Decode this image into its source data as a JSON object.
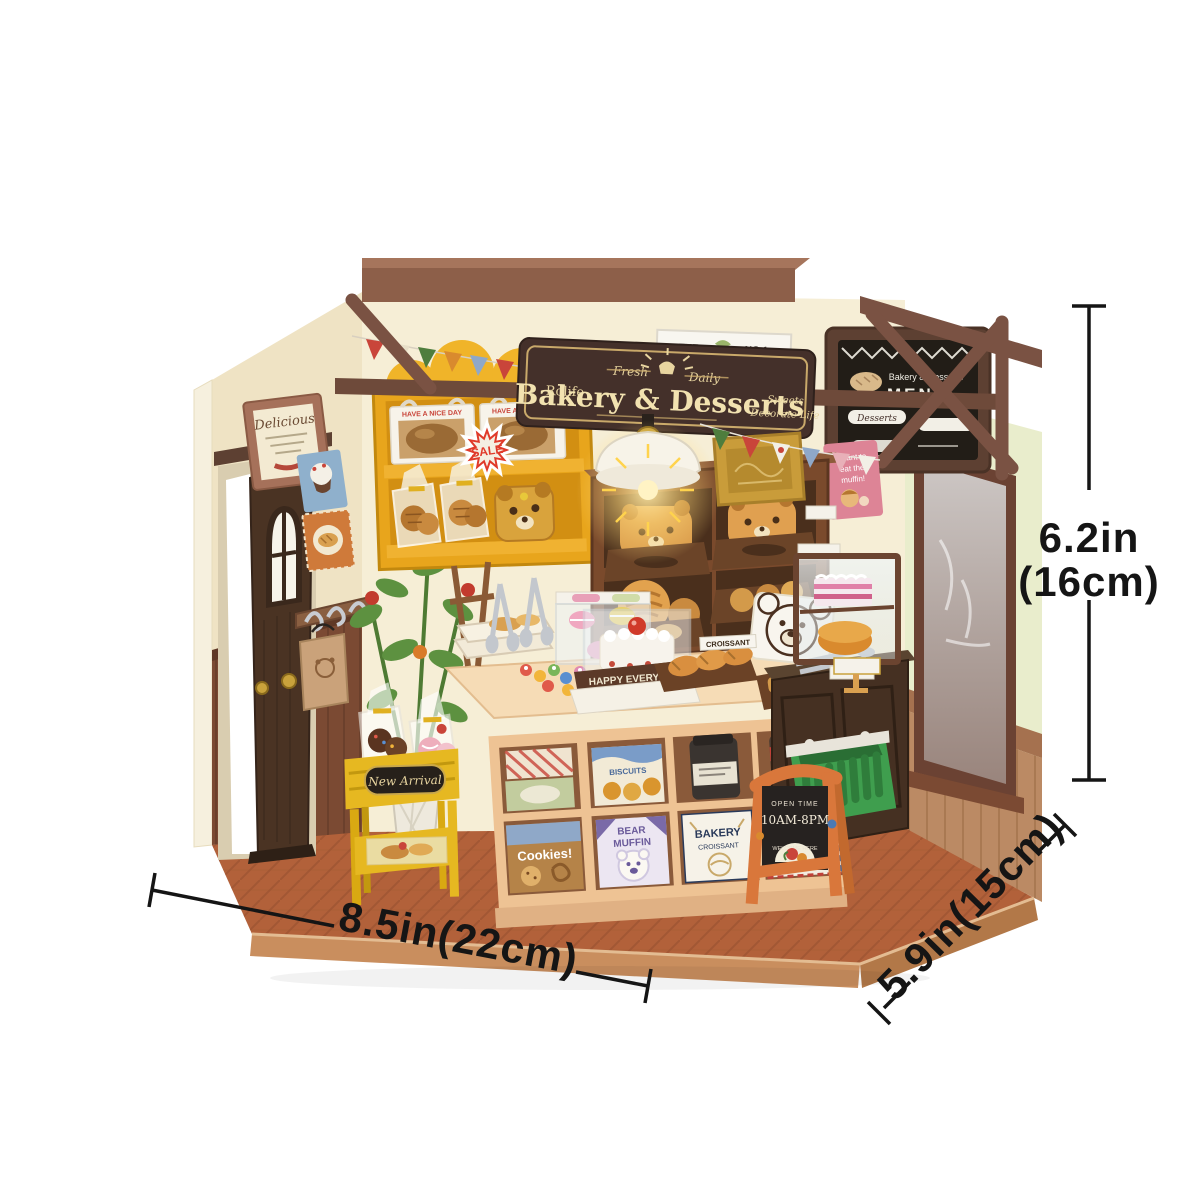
{
  "annotations": {
    "height_in": "6.2in",
    "height_cm": "(16cm)",
    "width_label": "8.5in(22cm)",
    "depth_label": "5.9in(15cm)"
  },
  "storefront": {
    "hanging_sign": {
      "brand": "Rolife",
      "title": "Bakery & Desserts",
      "banner_left": "Fresh",
      "banner_right": "Daily",
      "tagline_line1": "Sweets",
      "tagline_line2": "Decorate Life"
    },
    "wall_poster": {
      "line1": "THE",
      "line2": "NO.1",
      "line3": "YUM BAKERY"
    },
    "menu_board": {
      "header": "Bakery & Desserts",
      "title": "MENU",
      "item1": "Desserts"
    },
    "framed_print": "Delicious",
    "sale_badge": "SALE",
    "bread_box_text": "HAVE A NICE DAY",
    "sticky_note": {
      "line1": "I want to",
      "line2": "eat the",
      "line3": "muffin!"
    },
    "happy_sign": "HAPPY EVERYDAY",
    "croissant_tag": "CROISSANT",
    "new_arrival_plaque": "New Arrival",
    "open_sign": {
      "line1": "OPEN TIME",
      "line2": "10AM-8PM",
      "line3": "WELCOME HERE"
    },
    "counter_boxes": {
      "biscuits": "BISCUITS",
      "cookies": "Cookies!",
      "muffin_line1": "BEAR",
      "muffin_line2": "MUFFIN",
      "bakery_line1": "BAKERY",
      "bakery_line2": "CROISSANT",
      "croissant": "CROISSANT"
    }
  },
  "colors": {
    "wall_cream": "#f6eed6",
    "wall_mint": "#e9edcc",
    "wood_dark": "#6e4a3a",
    "wainscot": "#7b4a33",
    "floor_terracotta": "#b2613a",
    "shelf_yellow": "#e8a51c",
    "sign_brown": "#44302a",
    "sign_gold": "#d8b56a",
    "sale_red": "#e03a2a",
    "basket_green": "#3f9e4e",
    "aframe_orange": "#d9773b",
    "counter_peach": "#eec394",
    "annotation_black": "#151515"
  }
}
